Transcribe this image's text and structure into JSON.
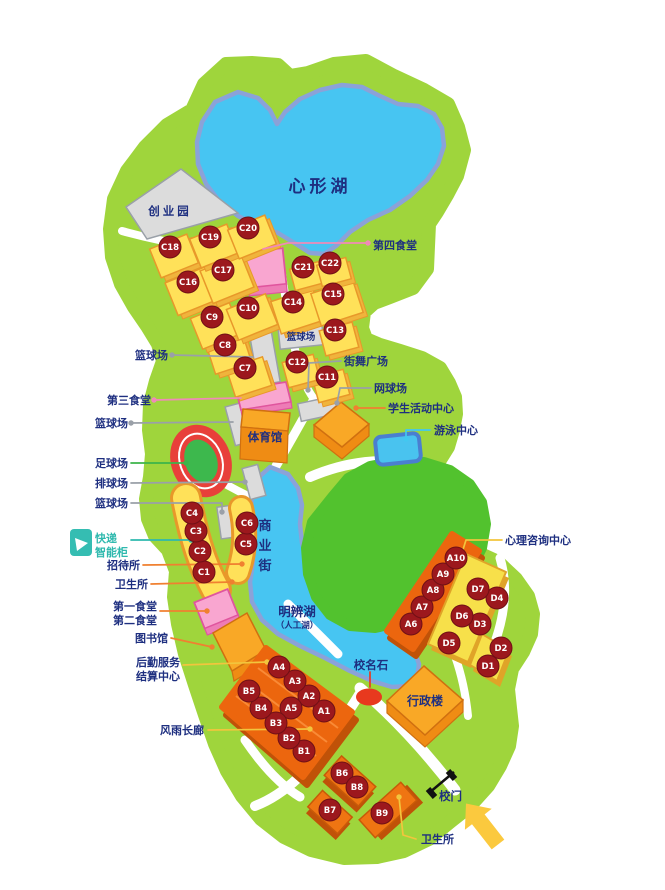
{
  "palette": {
    "land": "#9fd53c",
    "lawn": "#52c22e",
    "water": "#47c5f2",
    "water_border": "#8ba2d8",
    "yellow": "#ffe159",
    "yellow_side": "#f0b43c",
    "yellow_stroke": "#e8982a",
    "yellow_slab": "#f7e04a",
    "yellow_slab_stroke": "#e0a428",
    "orange_top": "#f9a826",
    "orange_side": "#ef8c14",
    "orange_stroke": "#d07010",
    "orange_dark": "#ec660e",
    "orange_shadow": "#c05208",
    "orange_cube": "#ef7512",
    "pink_building": "#f9a6d0",
    "pink_side": "#ee7cb6",
    "pink_stroke": "#e0559e",
    "gray_building": "#dcdcdc",
    "marker_red": "#9c181d",
    "marker_stroke": "#701016",
    "label_navy": "#1e2f80",
    "label_teal": "#2fb9ae",
    "line_gray": "#9aa0a8",
    "line_orange": "#f08030",
    "line_yellow": "#f2c53d",
    "line_pink": "#f08ab8",
    "line_cyan": "#42c8f0",
    "line_green": "#3cb44a",
    "line_red": "#e8391e",
    "stadium_track": "#e8403a",
    "stadium_field": "#3db84d",
    "pool": "#49c3ef",
    "pool_border": "#4a7fd0",
    "arrow_yellow": "#fbc93e"
  },
  "markers": {
    "radius": 11,
    "items": [
      {
        "id": "C1",
        "x": 204,
        "y": 572
      },
      {
        "id": "C2",
        "x": 200,
        "y": 551
      },
      {
        "id": "C3",
        "x": 196,
        "y": 531
      },
      {
        "id": "C4",
        "x": 192,
        "y": 513
      },
      {
        "id": "C5",
        "x": 246,
        "y": 544
      },
      {
        "id": "C6",
        "x": 247,
        "y": 523
      },
      {
        "id": "C7",
        "x": 245,
        "y": 368,
        "cube": [
          38,
          30,
          -18
        ]
      },
      {
        "id": "C8",
        "x": 225,
        "y": 345,
        "cube": [
          38,
          30,
          -18
        ]
      },
      {
        "id": "C9",
        "x": 212,
        "y": 317,
        "cube": [
          42,
          33,
          -22
        ]
      },
      {
        "id": "C10",
        "x": 248,
        "y": 308,
        "cube": [
          42,
          33,
          -22
        ]
      },
      {
        "id": "C11",
        "x": 327,
        "y": 377,
        "cube": [
          32,
          26,
          -15
        ]
      },
      {
        "id": "C12",
        "x": 297,
        "y": 362,
        "cube": [
          32,
          26,
          -15
        ]
      },
      {
        "id": "C13",
        "x": 335,
        "y": 330,
        "cube": [
          34,
          26,
          -15
        ]
      },
      {
        "id": "C14",
        "x": 293,
        "y": 302,
        "cube": [
          44,
          34,
          -18
        ]
      },
      {
        "id": "C15",
        "x": 333,
        "y": 294,
        "cube": [
          44,
          34,
          -18
        ]
      },
      {
        "id": "C16",
        "x": 188,
        "y": 282,
        "cube": [
          44,
          35,
          -22
        ]
      },
      {
        "id": "C17",
        "x": 223,
        "y": 270,
        "cube": [
          44,
          35,
          -22
        ]
      },
      {
        "id": "C18",
        "x": 170,
        "y": 247,
        "cube": [
          40,
          31,
          -22
        ]
      },
      {
        "id": "C19",
        "x": 210,
        "y": 237,
        "cube": [
          40,
          31,
          -22
        ]
      },
      {
        "id": "C20",
        "x": 248,
        "y": 228,
        "cube": [
          40,
          31,
          -22
        ]
      },
      {
        "id": "C21",
        "x": 303,
        "y": 267,
        "cube": [
          30,
          22,
          -15
        ]
      },
      {
        "id": "C22",
        "x": 330,
        "y": 263,
        "cube": [
          30,
          22,
          -15
        ]
      },
      {
        "id": "A1",
        "x": 324,
        "y": 711
      },
      {
        "id": "A2",
        "x": 309,
        "y": 696
      },
      {
        "id": "A3",
        "x": 295,
        "y": 681
      },
      {
        "id": "A4",
        "x": 279,
        "y": 667
      },
      {
        "id": "A5",
        "x": 291,
        "y": 708
      },
      {
        "id": "A6",
        "x": 411,
        "y": 624
      },
      {
        "id": "A7",
        "x": 422,
        "y": 607
      },
      {
        "id": "A8",
        "x": 433,
        "y": 590
      },
      {
        "id": "A9",
        "x": 443,
        "y": 574
      },
      {
        "id": "A10",
        "x": 456,
        "y": 558
      },
      {
        "id": "B1",
        "x": 304,
        "y": 751
      },
      {
        "id": "B2",
        "x": 289,
        "y": 738
      },
      {
        "id": "B3",
        "x": 276,
        "y": 723
      },
      {
        "id": "B4",
        "x": 261,
        "y": 708
      },
      {
        "id": "B5",
        "x": 249,
        "y": 691
      },
      {
        "id": "B6",
        "x": 342,
        "y": 773
      },
      {
        "id": "B7",
        "x": 330,
        "y": 810
      },
      {
        "id": "B8",
        "x": 357,
        "y": 787
      },
      {
        "id": "B9",
        "x": 382,
        "y": 813
      },
      {
        "id": "D1",
        "x": 488,
        "y": 666
      },
      {
        "id": "D2",
        "x": 501,
        "y": 648
      },
      {
        "id": "D3",
        "x": 480,
        "y": 624
      },
      {
        "id": "D4",
        "x": 497,
        "y": 598
      },
      {
        "id": "D5",
        "x": 449,
        "y": 643
      },
      {
        "id": "D6",
        "x": 462,
        "y": 616
      },
      {
        "id": "D7",
        "x": 478,
        "y": 589
      }
    ]
  },
  "labels": [
    {
      "id": "heart-lake",
      "text": "心形湖",
      "x": 320,
      "y": 192,
      "size": 17,
      "anchor": "middle",
      "ls": 4
    },
    {
      "id": "startup-park",
      "text": "创业园",
      "x": 170,
      "y": 215,
      "size": 11.5,
      "anchor": "middle",
      "ls": 3
    },
    {
      "id": "fourth-canteen",
      "text": "第四食堂",
      "x": 373,
      "y": 249
    },
    {
      "id": "basketball-top",
      "text": "篮球场",
      "x": 168,
      "y": 359,
      "anchor": "end"
    },
    {
      "id": "street-dance-plaza",
      "text": "街舞广场",
      "x": 344,
      "y": 365
    },
    {
      "id": "tennis-court",
      "text": "网球场",
      "x": 374,
      "y": 392
    },
    {
      "id": "third-canteen",
      "text": "第三食堂",
      "x": 151,
      "y": 404,
      "anchor": "end"
    },
    {
      "id": "student-activity-center",
      "text": "学生活动中心",
      "x": 388,
      "y": 412
    },
    {
      "id": "basketball-2",
      "text": "篮球场",
      "x": 128,
      "y": 427,
      "anchor": "end"
    },
    {
      "id": "swimming-center",
      "text": "游泳中心",
      "x": 434,
      "y": 434
    },
    {
      "id": "gymnasium",
      "text": "体育馆",
      "x": 265,
      "y": 441,
      "size": 11.5,
      "anchor": "middle"
    },
    {
      "id": "football-field",
      "text": "足球场",
      "x": 128,
      "y": 467,
      "anchor": "end"
    },
    {
      "id": "volleyball-court",
      "text": "排球场",
      "x": 128,
      "y": 487,
      "anchor": "end"
    },
    {
      "id": "basketball-3",
      "text": "篮球场",
      "x": 128,
      "y": 507,
      "anchor": "end"
    },
    {
      "id": "basketball-court-label",
      "text": "篮球场",
      "x": 301,
      "y": 340,
      "size": 9.5,
      "anchor": "middle"
    },
    {
      "id": "express-locker-1",
      "text": "快递",
      "x": 95,
      "y": 542,
      "color": "label_teal"
    },
    {
      "id": "express-locker-2",
      "text": "智能柜",
      "x": 95,
      "y": 556,
      "color": "label_teal"
    },
    {
      "id": "commercial-street",
      "text": "商业街",
      "x": 265,
      "y": 530,
      "size": 13,
      "anchor": "middle",
      "vertical": true,
      "dy": 20
    },
    {
      "id": "guesthouse",
      "text": "招待所",
      "x": 140,
      "y": 569,
      "anchor": "end"
    },
    {
      "id": "clinic-1",
      "text": "卫生所",
      "x": 148,
      "y": 588,
      "anchor": "end"
    },
    {
      "id": "first-canteen",
      "text": "第一食堂",
      "x": 157,
      "y": 610,
      "anchor": "end"
    },
    {
      "id": "second-canteen",
      "text": "第二食堂",
      "x": 157,
      "y": 624,
      "anchor": "end"
    },
    {
      "id": "library",
      "text": "图书馆",
      "x": 168,
      "y": 642,
      "anchor": "end"
    },
    {
      "id": "logistics-1",
      "text": "后勤服务",
      "x": 180,
      "y": 666,
      "anchor": "end"
    },
    {
      "id": "logistics-2",
      "text": "结算中心",
      "x": 180,
      "y": 680,
      "anchor": "end"
    },
    {
      "id": "mingbian-lake",
      "text": "明辨湖",
      "x": 297,
      "y": 616,
      "size": 12.5,
      "anchor": "middle"
    },
    {
      "id": "artificial-lake",
      "text": "（人工湖）",
      "x": 297,
      "y": 628,
      "size": 8.5,
      "anchor": "middle"
    },
    {
      "id": "name-stone",
      "text": "校名石",
      "x": 371,
      "y": 669,
      "size": 11.5,
      "anchor": "middle"
    },
    {
      "id": "admin-building",
      "text": "行政楼",
      "x": 425,
      "y": 705,
      "size": 12,
      "anchor": "middle"
    },
    {
      "id": "counseling-center",
      "text": "心理咨询中心",
      "x": 505,
      "y": 544
    },
    {
      "id": "rain-corridor",
      "text": "风雨长廊",
      "x": 204,
      "y": 734,
      "anchor": "end"
    },
    {
      "id": "school-gate",
      "text": "校门",
      "x": 439,
      "y": 800,
      "size": 11.5
    },
    {
      "id": "clinic-2",
      "text": "卫生所",
      "x": 421,
      "y": 843
    }
  ],
  "leaders": [
    {
      "id": "fourth-canteen-line",
      "color": "line_pink",
      "points": [
        [
          263,
          249
        ],
        [
          288,
          243
        ],
        [
          368,
          243
        ]
      ],
      "dot": [
        368,
        243
      ]
    },
    {
      "id": "basketball-top-line",
      "color": "line_gray",
      "points": [
        [
          172,
          355
        ],
        [
          253,
          357
        ]
      ],
      "dot": [
        172,
        355
      ]
    },
    {
      "id": "street-dance-line",
      "color": "line_gray",
      "points": [
        [
          341,
          361
        ],
        [
          309,
          363
        ],
        [
          308,
          390
        ]
      ],
      "dot": [
        308,
        390
      ]
    },
    {
      "id": "tennis-line",
      "color": "line_gray",
      "points": [
        [
          371,
          388
        ],
        [
          340,
          388
        ],
        [
          337,
          403
        ]
      ],
      "dot": [
        337,
        403
      ]
    },
    {
      "id": "third-canteen-line",
      "color": "line_pink",
      "points": [
        [
          154,
          400
        ],
        [
          241,
          398
        ]
      ],
      "dot": [
        154,
        400
      ]
    },
    {
      "id": "student-center-line",
      "color": "line_orange",
      "points": [
        [
          385,
          408
        ],
        [
          356,
          408
        ]
      ],
      "dot": [
        356,
        408
      ]
    },
    {
      "id": "basketball-2-line",
      "color": "line_gray",
      "points": [
        [
          131,
          423
        ],
        [
          233,
          422
        ]
      ],
      "dot": [
        131,
        423
      ]
    },
    {
      "id": "swimming-line",
      "color": "line_cyan",
      "points": [
        [
          430,
          430
        ],
        [
          406,
          430
        ],
        [
          406,
          439
        ]
      ],
      "dot": [
        406,
        439
      ]
    },
    {
      "id": "football-line",
      "color": "line_green",
      "points": [
        [
          131,
          463
        ],
        [
          186,
          463
        ]
      ],
      "dot": [
        186,
        463
      ]
    },
    {
      "id": "volleyball-line",
      "color": "line_gray",
      "points": [
        [
          131,
          483
        ],
        [
          245,
          482
        ]
      ],
      "dot": [
        245,
        482
      ]
    },
    {
      "id": "basketball-3-line",
      "color": "line_gray",
      "points": [
        [
          131,
          503
        ],
        [
          222,
          503
        ],
        [
          222,
          512
        ]
      ],
      "dot": [
        222,
        512
      ]
    },
    {
      "id": "locker-line",
      "color": "label_teal",
      "points": [
        [
          131,
          540
        ],
        [
          191,
          540
        ]
      ],
      "dot": [
        191,
        540
      ]
    },
    {
      "id": "guesthouse-line",
      "color": "line_orange",
      "points": [
        [
          143,
          565
        ],
        [
          242,
          564
        ]
      ],
      "dot": [
        242,
        564
      ]
    },
    {
      "id": "clinic-1-line",
      "color": "line_orange",
      "points": [
        [
          151,
          584
        ],
        [
          232,
          582
        ]
      ],
      "dot": [
        232,
        582
      ]
    },
    {
      "id": "canteen-12-line",
      "color": "line_orange",
      "points": [
        [
          160,
          611
        ],
        [
          207,
          611
        ]
      ],
      "dot": [
        207,
        611
      ]
    },
    {
      "id": "library-line",
      "color": "line_orange",
      "points": [
        [
          171,
          638
        ],
        [
          212,
          647
        ]
      ],
      "dot": [
        212,
        647
      ]
    },
    {
      "id": "logistics-line",
      "color": "line_yellow",
      "points": [
        [
          183,
          665
        ],
        [
          267,
          662
        ]
      ],
      "dot": [
        267,
        662
      ]
    },
    {
      "id": "corridor-line",
      "color": "line_yellow",
      "points": [
        [
          208,
          730
        ],
        [
          310,
          729
        ]
      ],
      "dot": [
        310,
        729
      ]
    },
    {
      "id": "counseling-line",
      "color": "line_yellow",
      "points": [
        [
          502,
          540
        ],
        [
          466,
          540
        ],
        [
          461,
          556
        ]
      ],
      "dot": [
        461,
        556
      ]
    },
    {
      "id": "stone-line",
      "color": "line_red",
      "points": [
        [
          370,
          672
        ],
        [
          370,
          687
        ]
      ],
      "dot": null
    },
    {
      "id": "clinic-2-line",
      "color": "line_yellow",
      "points": [
        [
          399,
          797
        ],
        [
          403,
          835
        ],
        [
          416,
          839
        ]
      ],
      "dot": [
        399,
        797
      ]
    }
  ]
}
